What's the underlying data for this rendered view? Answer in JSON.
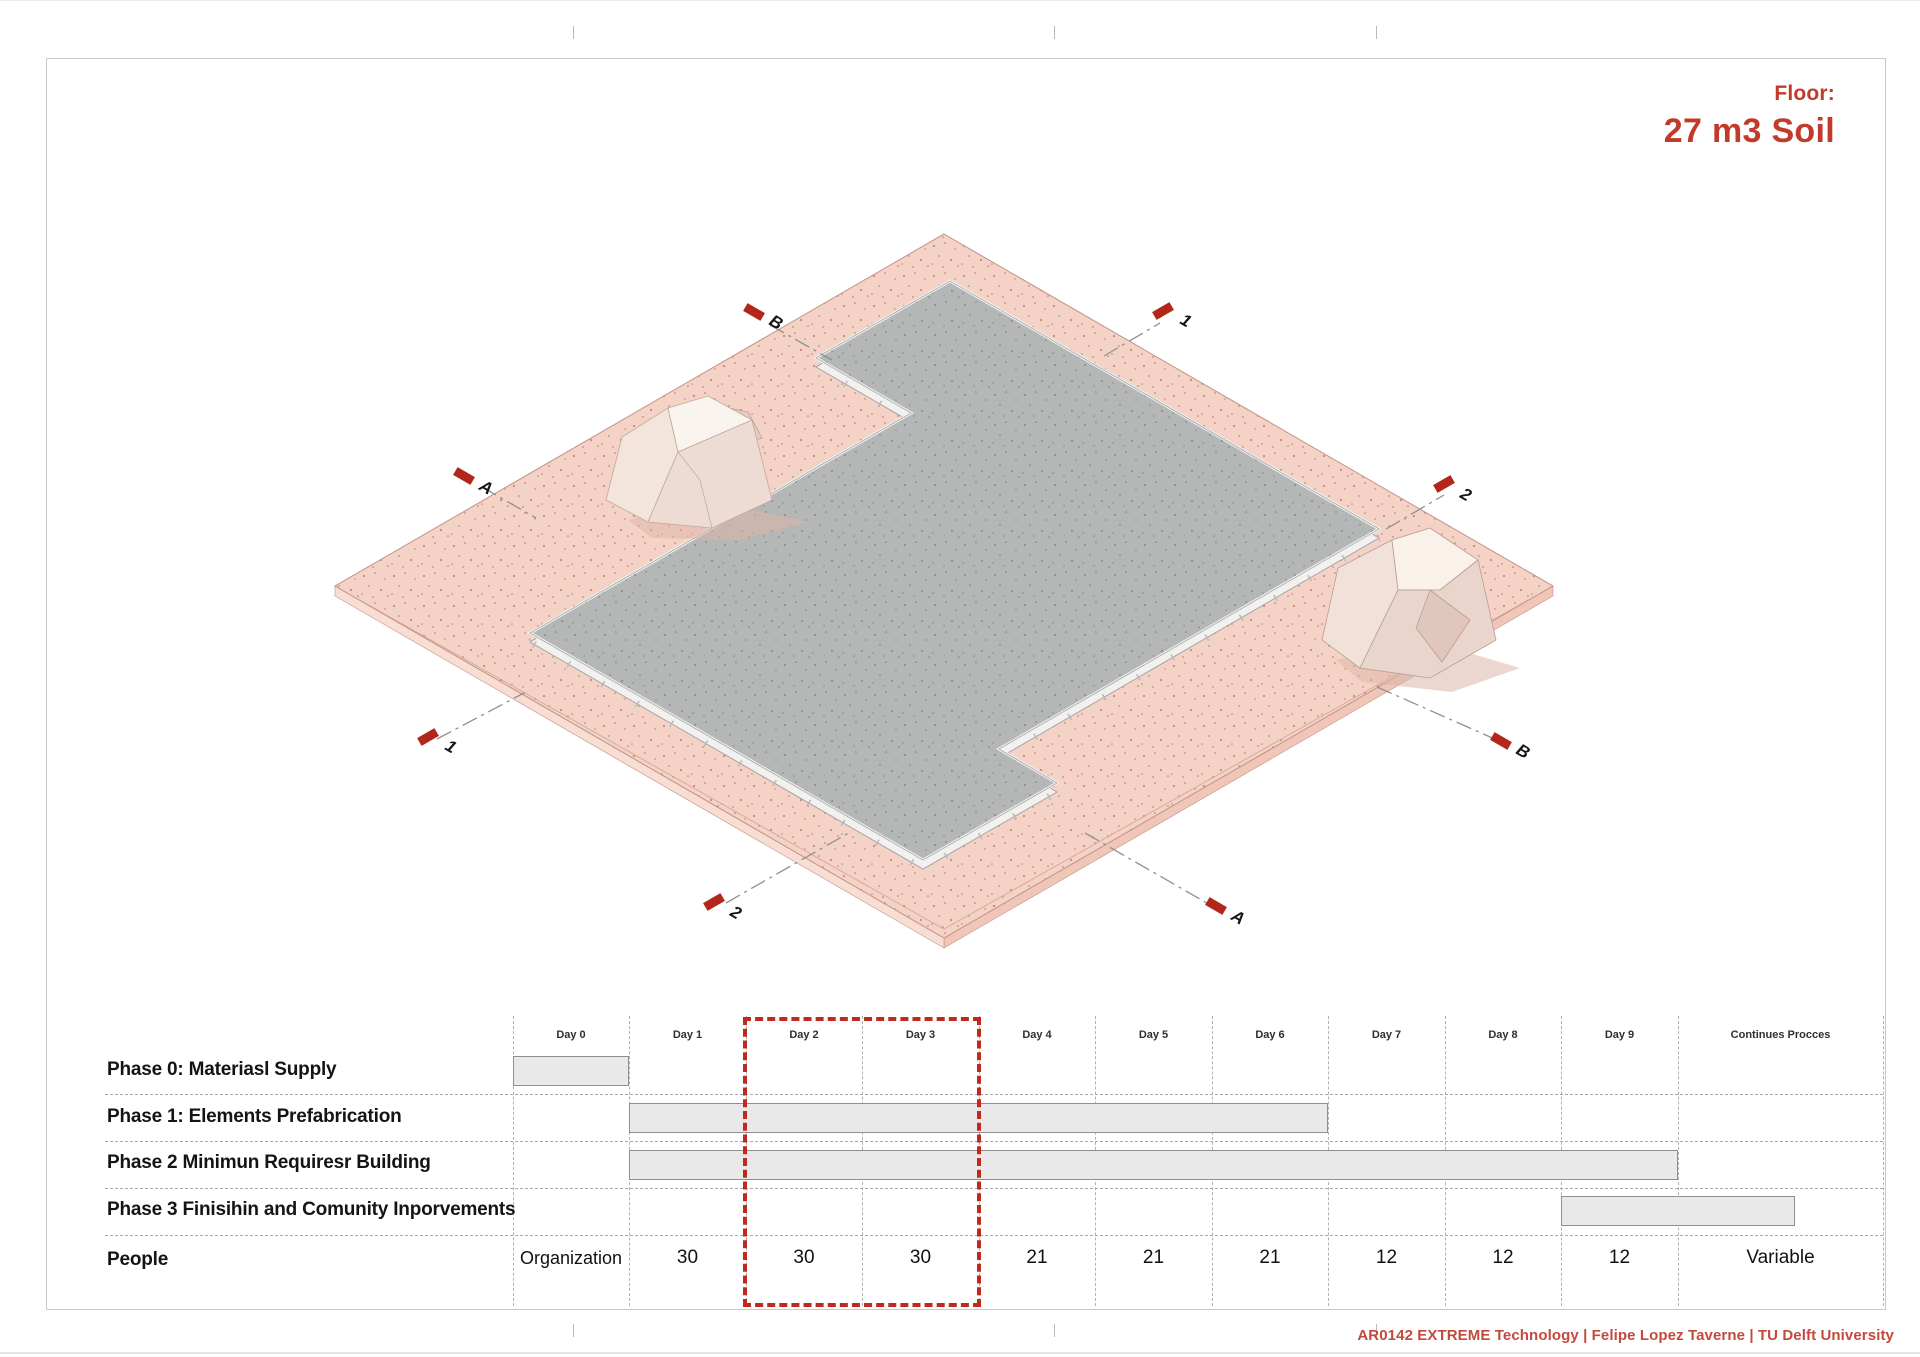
{
  "page": {
    "title_label": "Floor:",
    "title_value": "27 m3 Soil",
    "footer_credit": "AR0142 EXTREME Technology | Felipe Lopez Taverne | TU Delft University"
  },
  "drawing": {
    "description": "Isometric view of a pink soil plot with a gray floor slab and two soil heaps, with section markers",
    "section_tags": [
      {
        "label": "B"
      },
      {
        "label": "1"
      },
      {
        "label": "A"
      },
      {
        "label": "2"
      },
      {
        "label": "1"
      },
      {
        "label": "B"
      },
      {
        "label": "2"
      },
      {
        "label": "A"
      }
    ]
  },
  "gantt": {
    "columns": [
      "Day 0",
      "Day 1",
      "Day 2",
      "Day 3",
      "Day 4",
      "Day 5",
      "Day 6",
      "Day 7",
      "Day 8",
      "Day 9",
      "Continues Procces"
    ],
    "rows": [
      {
        "label": "Phase 0: Materiasl Supply",
        "start_col": 0,
        "end_col": 1
      },
      {
        "label": "Phase 1: Elements Prefabrication",
        "start_col": 1,
        "end_col": 7
      },
      {
        "label": "Phase 2 Minimun Requiresr Building",
        "start_col": 1,
        "end_col": 10
      },
      {
        "label": "Phase 3 Finisihin and Comunity Inporvements",
        "start_col": 9,
        "end_col": 11
      }
    ],
    "people": {
      "label": "People",
      "values": [
        "Organization",
        "30",
        "30",
        "30",
        "21",
        "21",
        "21",
        "12",
        "12",
        "12",
        "Variable"
      ]
    },
    "highlight_columns": [
      "Day 2",
      "Day 3"
    ]
  },
  "chart_data": {
    "type": "table",
    "title": "Construction phasing schedule (Gantt)",
    "columns": [
      "Day 0",
      "Day 1",
      "Day 2",
      "Day 3",
      "Day 4",
      "Day 5",
      "Day 6",
      "Day 7",
      "Day 8",
      "Day 9",
      "Continues Procces"
    ],
    "bars": [
      {
        "name": "Phase 0: Materiasl Supply",
        "from": "Day 0",
        "to": "Day 0"
      },
      {
        "name": "Phase 1: Elements Prefabrication",
        "from": "Day 1",
        "to": "Day 6"
      },
      {
        "name": "Phase 2 Minimun Requiresr Building",
        "from": "Day 1",
        "to": "Day 9"
      },
      {
        "name": "Phase 3 Finisihin and Comunity Inporvements",
        "from": "Day 9",
        "to": "Continues Procces"
      }
    ],
    "people_per_day": [
      "Organization",
      "30",
      "30",
      "30",
      "21",
      "21",
      "21",
      "12",
      "12",
      "12",
      "Variable"
    ],
    "highlighted_days": [
      "Day 2",
      "Day 3"
    ]
  },
  "colors": {
    "accent_red": "#c23a2b",
    "footer_red": "#c4493d",
    "tag_red": "#b2271a",
    "highlight_red": "#c1291c",
    "plate_pink": "#f5d2c6",
    "slab_gray": "#b5b7b6",
    "bar_fill": "#e9e9e9",
    "grid_gray": "#aaaaaa"
  }
}
